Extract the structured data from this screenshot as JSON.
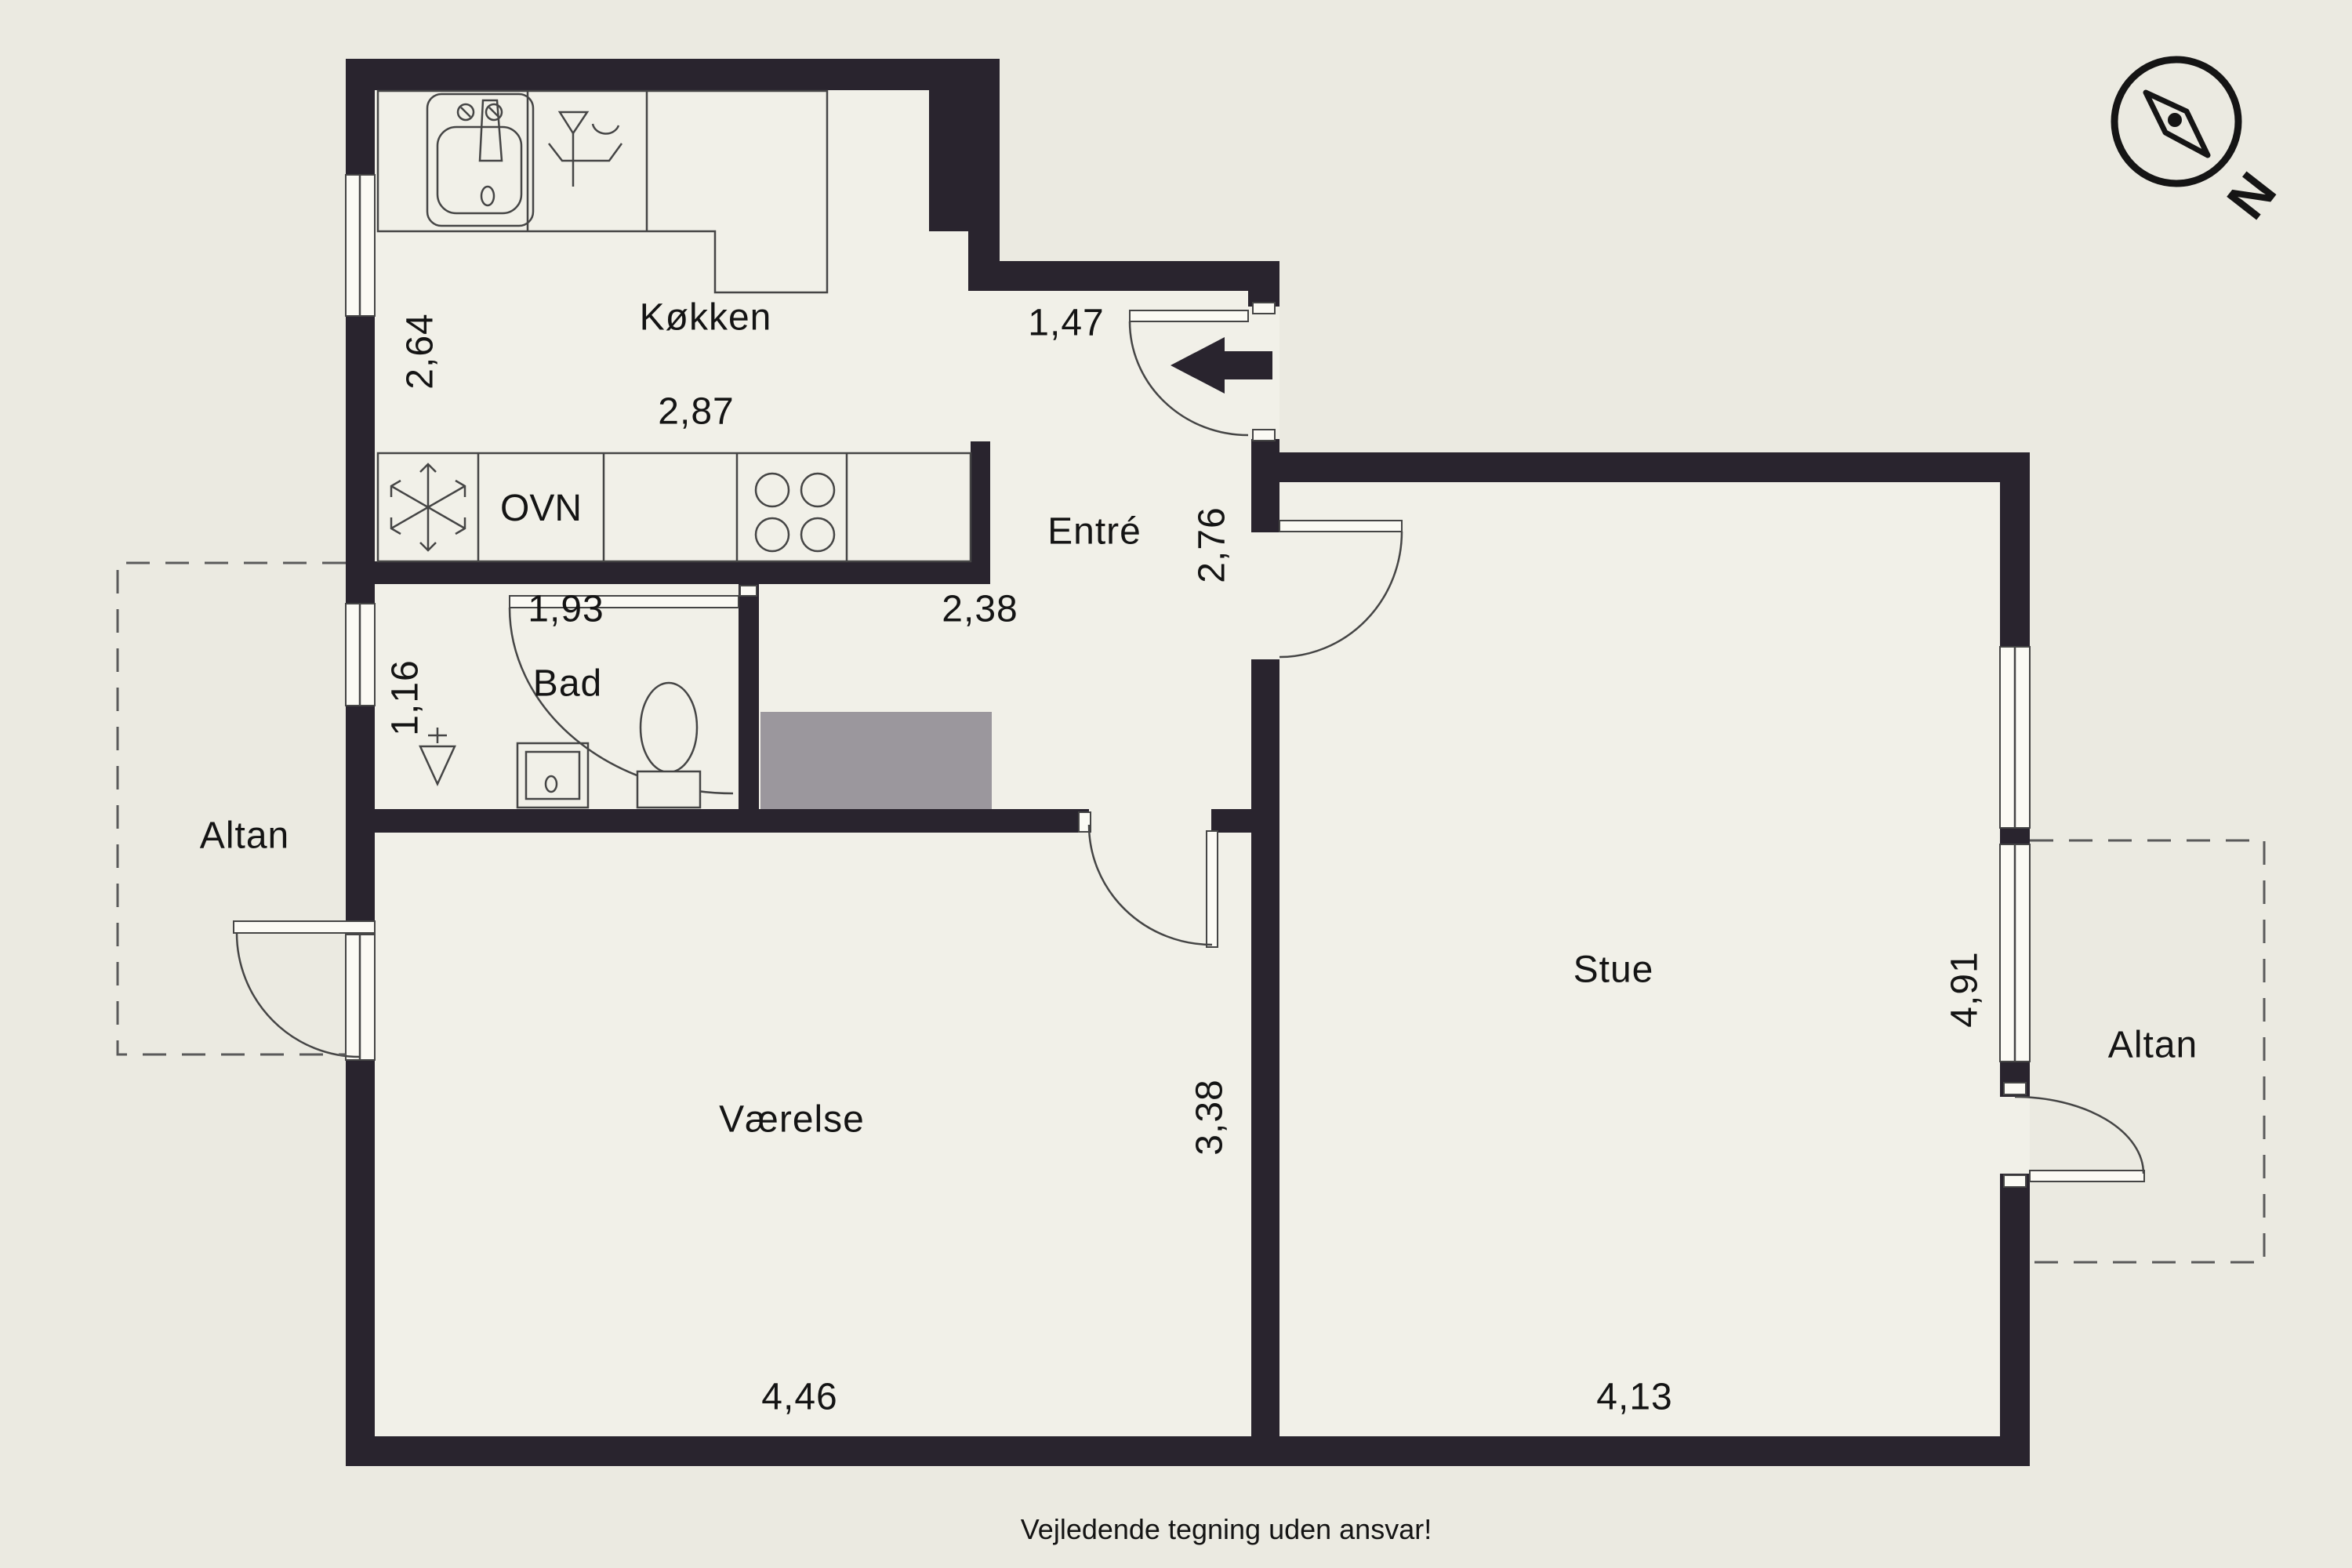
{
  "plan": {
    "rooms": {
      "kitchen": "Køkken",
      "entry": "Entré",
      "bathroom": "Bad",
      "bedroom": "Værelse",
      "living_room": "Stue",
      "balcony_left": "Altan",
      "balcony_right": "Altan"
    },
    "dims": {
      "kitchen_w": "2,87",
      "kitchen_h": "2,64",
      "entry_w": "1,47",
      "entry_h": "2,76",
      "bathroom_w": "1,93",
      "hall_w": "2,38",
      "bathroom_h": "1,16",
      "bedroom_w": "4,46",
      "bedroom_h": "3,38",
      "living_w": "4,13",
      "living_h": "4,91"
    },
    "appliances": {
      "oven": "OVN"
    },
    "compass": {
      "north": "N"
    },
    "disclaimer": "Vejledende tegning uden ansvar!"
  },
  "colors": {
    "wall": "#29242e",
    "background": "#ebeae1",
    "floor": "#f1f0e8",
    "line": "#454545",
    "wardrobe": "#9b979d"
  }
}
